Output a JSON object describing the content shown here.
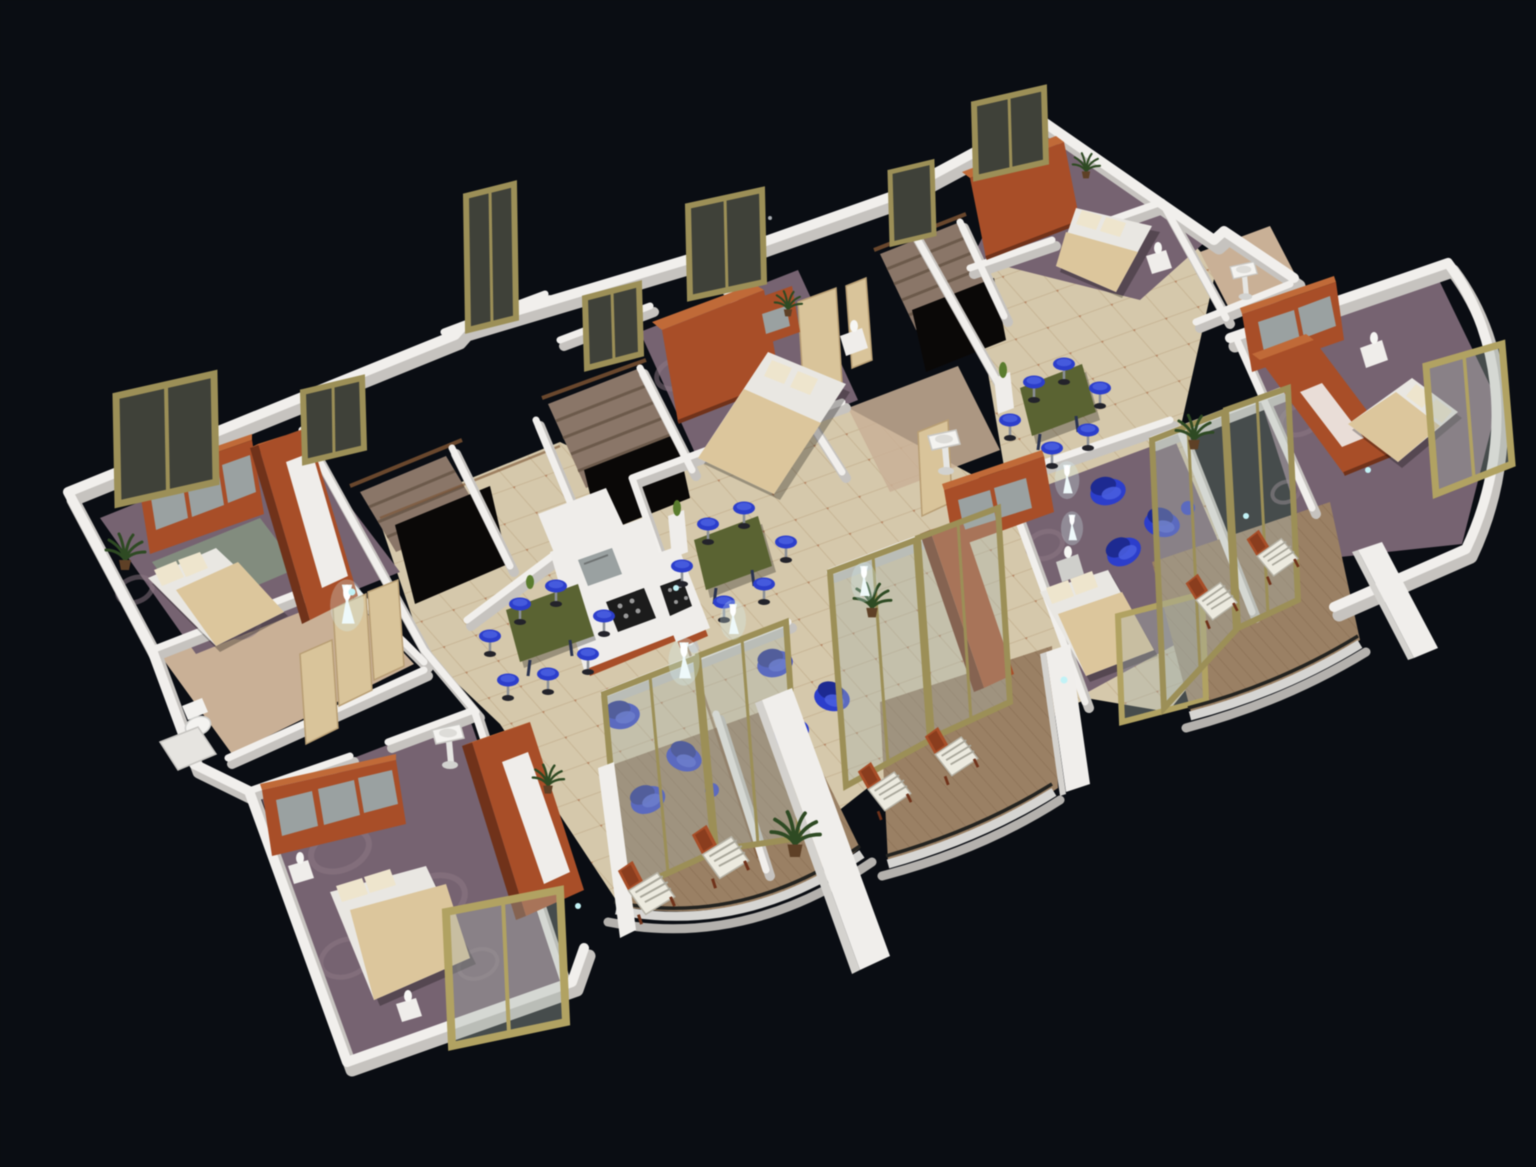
{
  "meta": {
    "description": "3D isometric architectural rendering of a residential floor plan viewed from above on a black background",
    "render_type": "architectural-3d-floor-plan"
  },
  "canvas": {
    "width": 1536,
    "height": 1167
  },
  "palette": {
    "background": "#0a0d13",
    "wallTop": "#f1efec",
    "wallShade": "#c6c3bf",
    "tile": "#d5c8ab",
    "tileLine": "#bda886",
    "bathFloor": "#c9b096",
    "balconyWood": "#9a8064",
    "carpet": "#766371",
    "carpetRing": "#8d7a85",
    "wood": "#a84e28",
    "woodDark": "#70321a",
    "woodTop": "#c06a38",
    "drawer": "#9aa1a1",
    "mattress": "#e9e7e2",
    "linen": "#dcc69c",
    "linenLight": "#eee5cd",
    "blue": "#2c3ecb",
    "blueDark": "#1d2a91",
    "blueHi": "#4a5fe0",
    "table": "#5a6332",
    "glass": "#3f4139",
    "frame": "#9c8f57",
    "frameBright": "#b1a262",
    "stair": "#8a7668",
    "stairDark": "#685848",
    "void": "#0a0807",
    "railing": "#d6d5d2",
    "railDark": "#232320",
    "glow": "#d9f5f7",
    "plant": "#2e4a23",
    "trimWood": "#7a5232"
  },
  "scene": {
    "background": "#0a0d13",
    "view": "isometric top-down oblique, plan runs diagonally from lower-left to upper-right",
    "units": [
      {
        "name": "left-apartment",
        "rooms": [
          "bedroom-northwest",
          "bathroom",
          "stairwell",
          "kitchen",
          "dining-area",
          "living-room",
          "bedroom-south",
          "balcony"
        ],
        "furniture": [
          "double-bed",
          "sideboard",
          "wardrobe",
          "kitchen-island",
          "dining-table",
          "bar-stools",
          "armchairs",
          "floor-lamps",
          "lounge-chairs",
          "plants"
        ]
      },
      {
        "name": "middle-apartment",
        "rooms": [
          "bedroom-north",
          "stairwell",
          "bathroom",
          "kitchen-counter",
          "dining-area",
          "living-room",
          "bedroom-south",
          "balcony"
        ],
        "furniture": [
          "double-bed",
          "wardrobe",
          "desk",
          "dining-table",
          "bar-stools",
          "armchairs",
          "sideboard",
          "floor-lamps",
          "lounge-chairs"
        ]
      },
      {
        "name": "right-apartment",
        "rooms": [
          "bedroom-north",
          "stairwell",
          "bathroom",
          "dining-area",
          "living-room",
          "bedroom-east",
          "balcony"
        ],
        "furniture": [
          "double-bed",
          "wardrobe",
          "sideboard",
          "dining-table",
          "bar-stools",
          "armchairs",
          "floor-lamps",
          "lounge-chairs",
          "plants"
        ]
      }
    ],
    "counts": {
      "beds": 6,
      "stair_flights": 3,
      "balconies": 3,
      "standing_windows": 10,
      "glass_partitions": 6,
      "blue_bar_stools": 19,
      "blue_armchairs": 9,
      "balcony_lounge_chairs": 6,
      "glowing_floor_lamps": 6,
      "plants": 7,
      "pedestal_sinks": 3
    }
  }
}
